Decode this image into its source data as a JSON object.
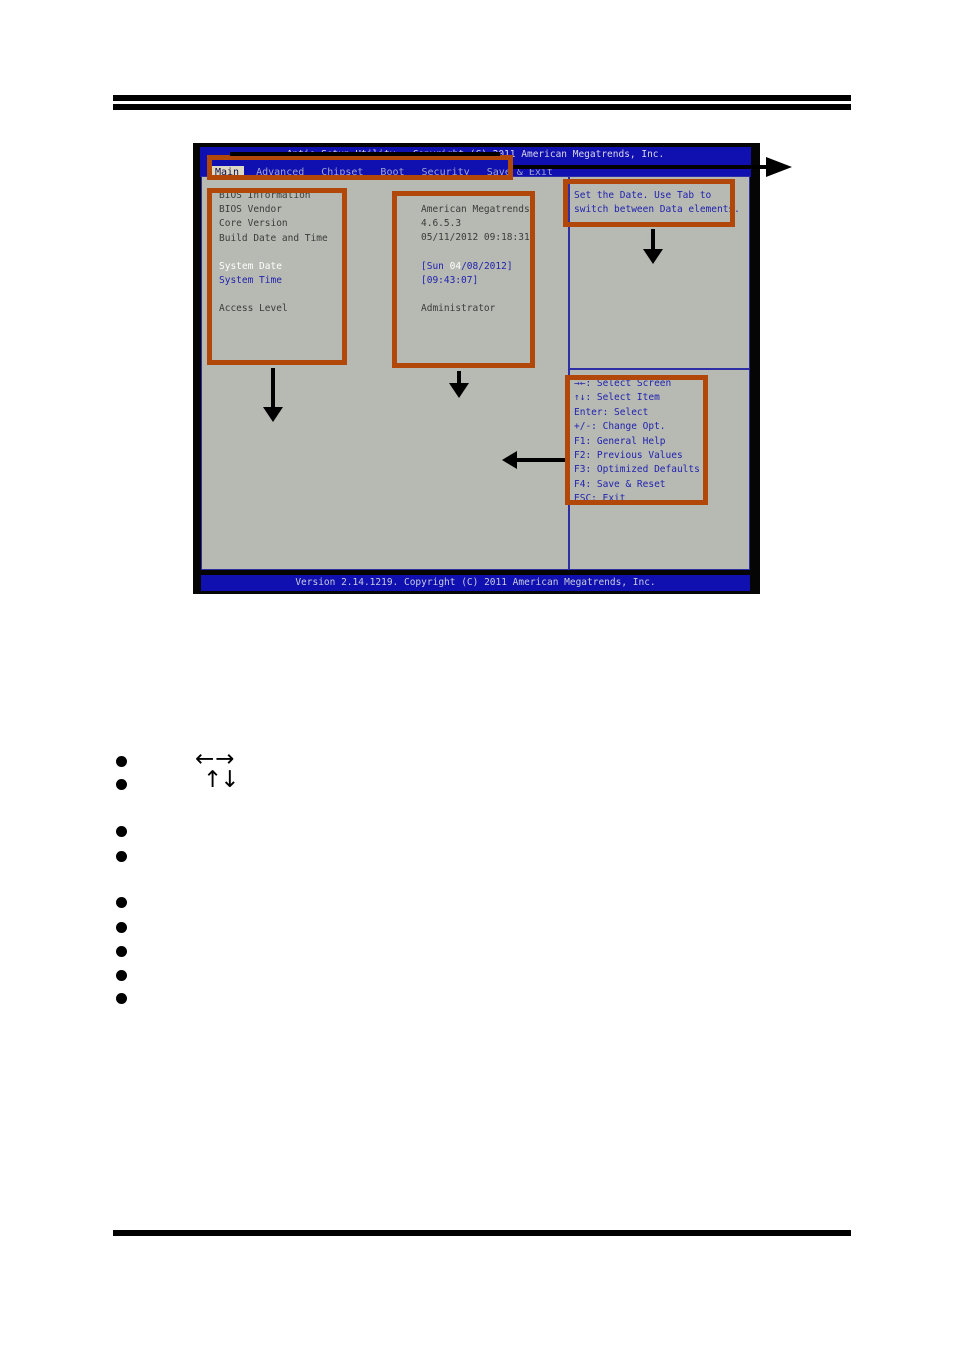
{
  "bios": {
    "title": "Aptio Setup Utility - Copyright (C) 2011 American Megatrends, Inc.",
    "tabs": [
      "Main",
      "Advanced",
      "Chipset",
      "Boot",
      "Security",
      "Save & Exit"
    ],
    "selected_tab": "Main",
    "info": {
      "section_header": "BIOS Information",
      "labels": [
        "BIOS Vendor",
        "Core Version",
        "Build Date and Time"
      ],
      "values": [
        "American Megatrends",
        "4.6.5.3",
        "05/11/2012 09:18:31"
      ]
    },
    "fields": {
      "system_date_label": "System Date",
      "system_date_pre": "[Sun ",
      "system_date_sel": "04",
      "system_date_post": "/08/2012]",
      "system_time_label": "System Time",
      "system_time_value": "[09:43:07]",
      "access_level_label": "Access Level",
      "access_level_value": "Administrator"
    },
    "help": {
      "line1": "Set the Date. Use Tab to",
      "line2": "switch between Data elements."
    },
    "hotkeys": [
      "→←: Select Screen",
      "↑↓: Select Item",
      "Enter: Select",
      "+/-: Change Opt.",
      "F1: General Help",
      "F2: Previous Values",
      "F3: Optimized Defaults",
      "F4: Save & Reset",
      "ESC: Exit"
    ],
    "status": "Version 2.14.1219. Copyright (C) 2011 American Megatrends, Inc."
  },
  "annotations": {
    "arrow_left_right": "←→",
    "arrow_up_down": "↑↓"
  },
  "colors": {
    "bios_blue": "#1010b0",
    "panel_gray": "#b6bab2",
    "annotation_orange": "#b14708",
    "bios_text_blue": "#2222b0",
    "bios_text_dark": "#3c3c3c",
    "highlight_white": "#ffffff"
  }
}
